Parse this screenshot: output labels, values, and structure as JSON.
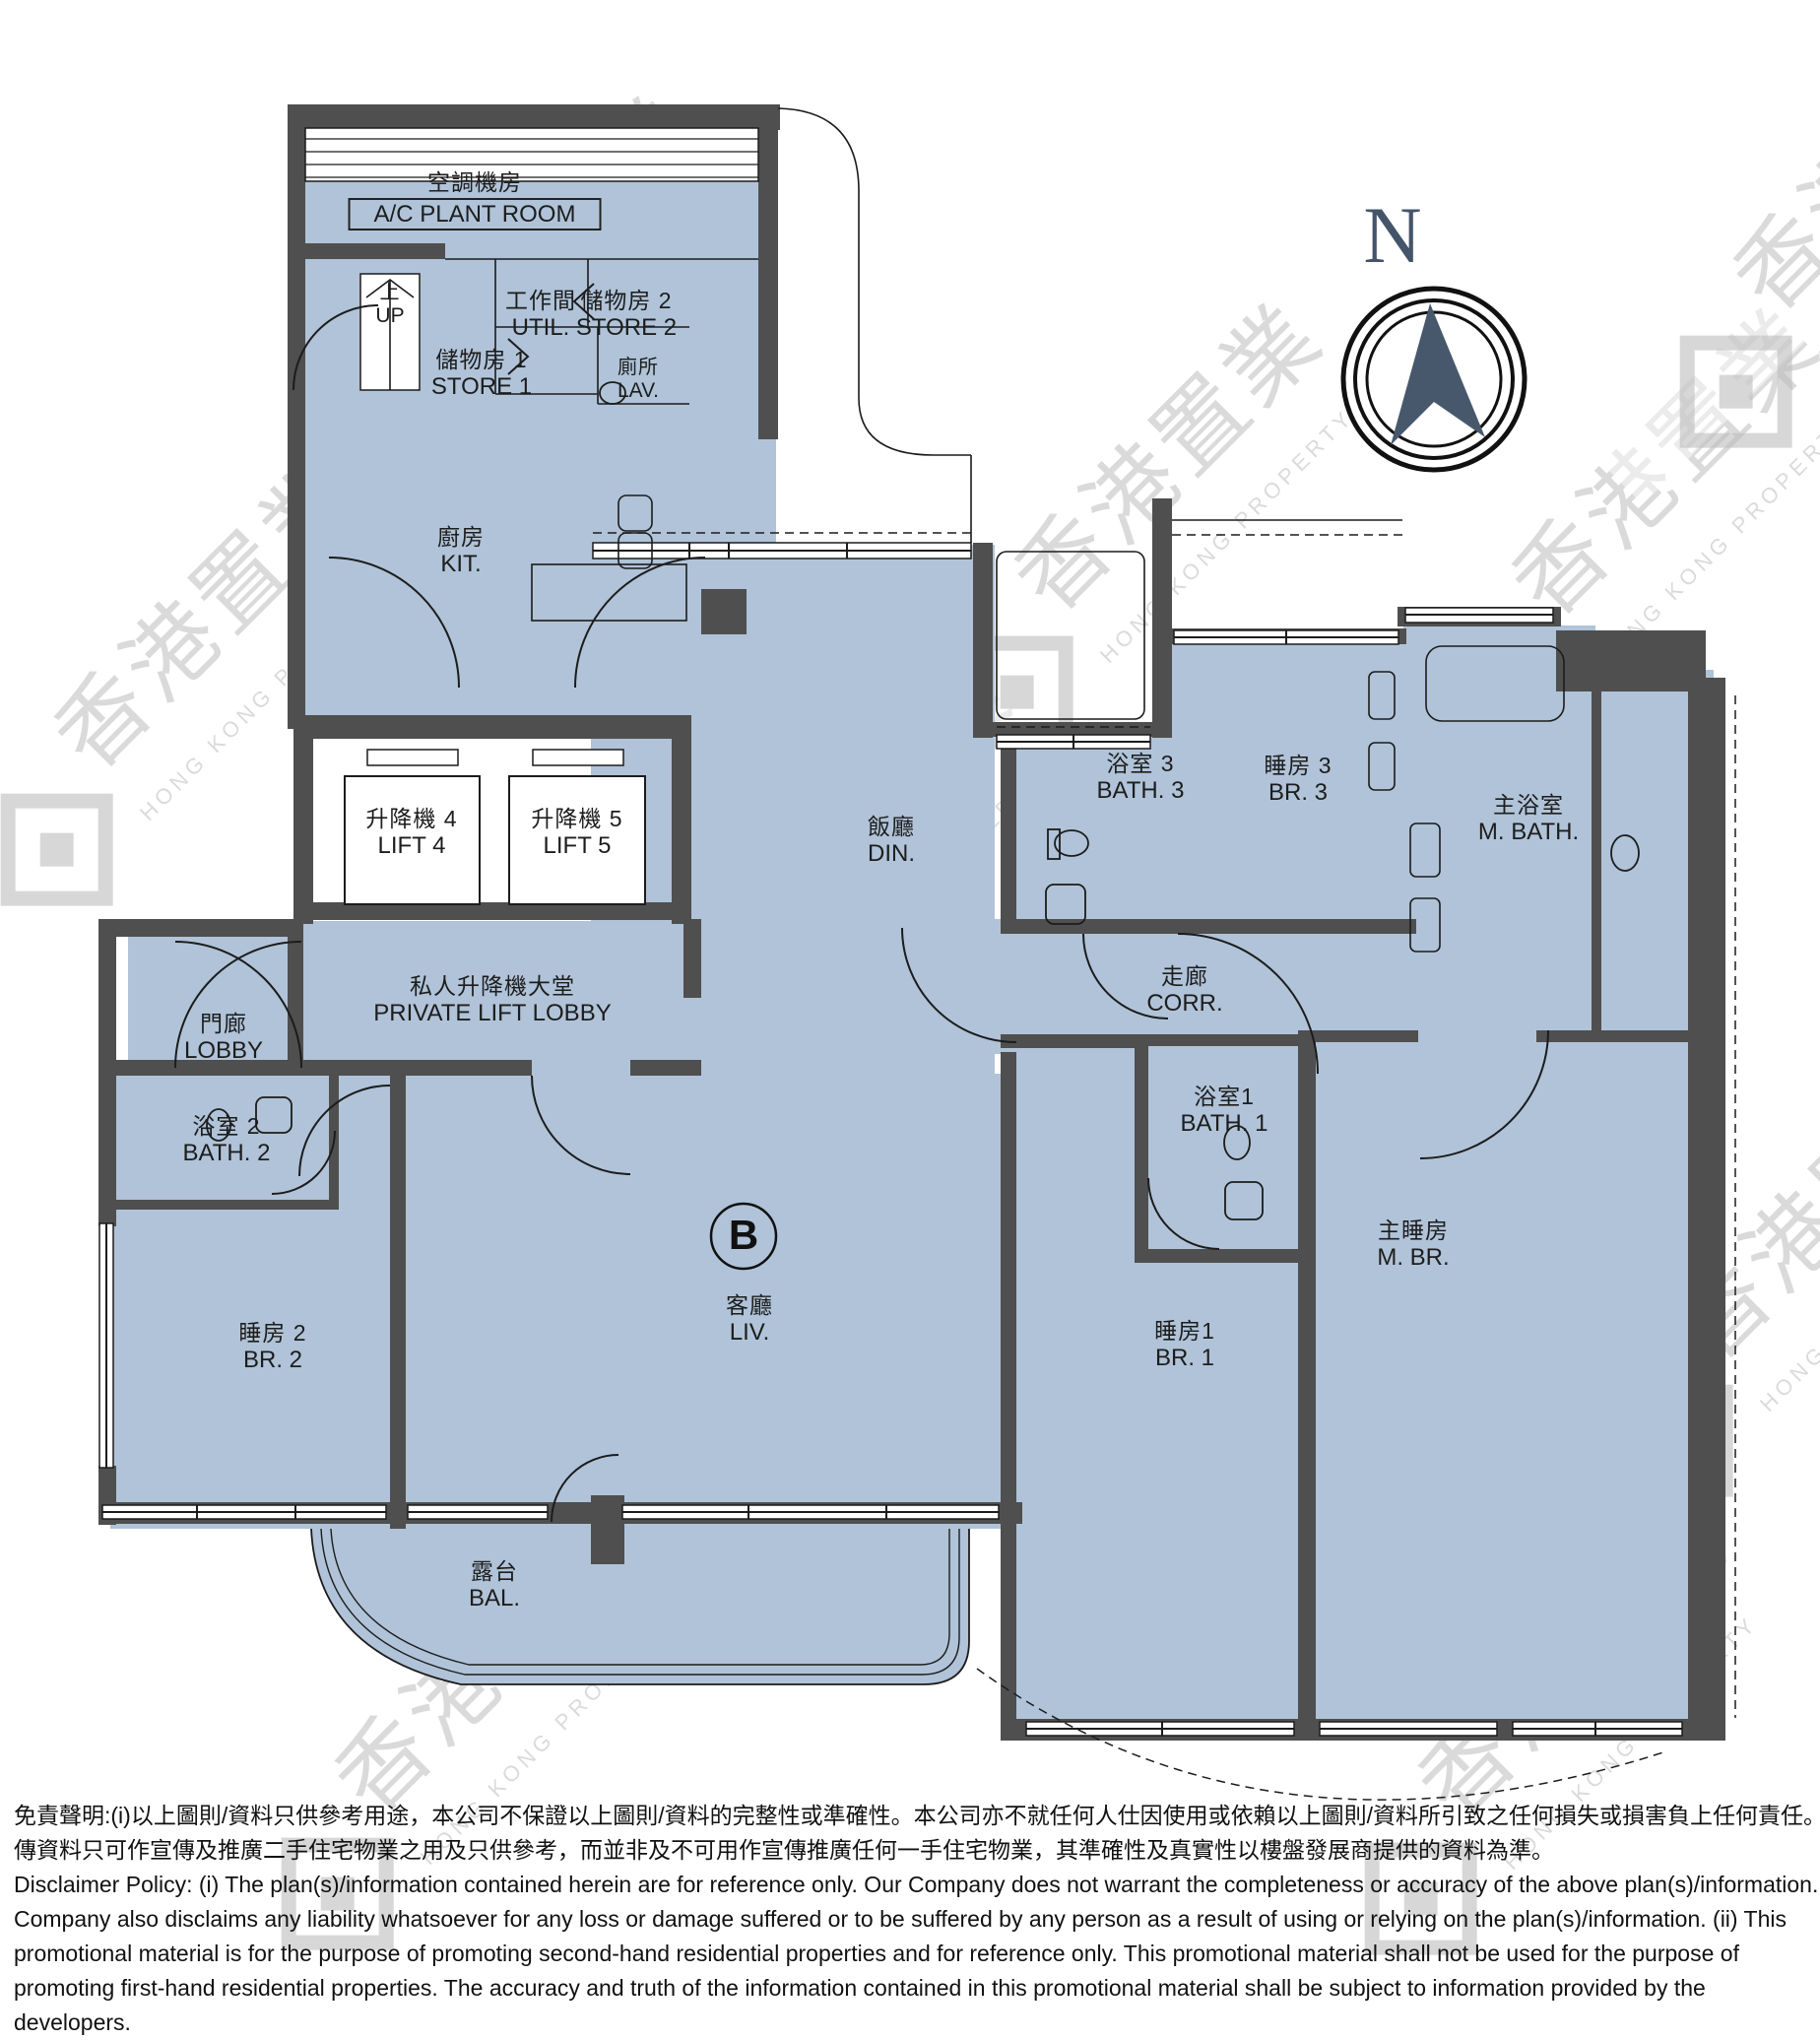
{
  "unit": "B",
  "compass_n": "N",
  "watermark": {
    "zh": "香港置業",
    "en": "HONG KONG PROPERTY"
  },
  "colors": {
    "floor": "#b0c3d8",
    "wall": "#4f4f4f",
    "compass": "#47586c",
    "line": "#1c1c1c"
  },
  "rooms": {
    "ac": {
      "zh": "空調機房",
      "en": "A/C PLANT ROOM"
    },
    "up": {
      "zh": "上",
      "en": "UP"
    },
    "util": {
      "zh": "工作間",
      "en": "UTIL."
    },
    "store2": {
      "zh": "儲物房 2",
      "en": "STORE 2"
    },
    "store1": {
      "zh": "儲物房 1",
      "en": "STORE 1"
    },
    "lav": {
      "zh": "廁所",
      "en": "LAV."
    },
    "kit": {
      "zh": "廚房",
      "en": "KIT."
    },
    "lift4": {
      "zh": "升降機 4",
      "en": "LIFT 4"
    },
    "lift5": {
      "zh": "升降機 5",
      "en": "LIFT 5"
    },
    "din": {
      "zh": "飯廳",
      "en": "DIN."
    },
    "bath3": {
      "zh": "浴室 3",
      "en": "BATH. 3"
    },
    "br3": {
      "zh": "睡房 3",
      "en": "BR. 3"
    },
    "mbath": {
      "zh": "主浴室",
      "en": "M. BATH."
    },
    "plobby": {
      "zh": "私人升降機大堂",
      "en": "PRIVATE LIFT LOBBY"
    },
    "lobby": {
      "zh": "門廊",
      "en": "LOBBY"
    },
    "corr": {
      "zh": "走廊",
      "en": "CORR."
    },
    "bath2": {
      "zh": "浴室 2",
      "en": "BATH. 2"
    },
    "bath1": {
      "zh": "浴室1",
      "en": "BATH. 1"
    },
    "br2": {
      "zh": "睡房 2",
      "en": "BR. 2"
    },
    "liv": {
      "zh": "客廳",
      "en": "LIV."
    },
    "br1": {
      "zh": "睡房1",
      "en": "BR. 1"
    },
    "mbr": {
      "zh": "主睡房",
      "en": "M. BR."
    },
    "bal": {
      "zh": "露台",
      "en": "BAL."
    }
  },
  "disclaimer": {
    "lines": [
      "免責聲明:(i)以上圖則/資料只供參考用途，本公司不保證以上圖則/資料的完整性或準確性。本公司亦不就任何人仕因使用或依賴以上圖則/資料所引致之任何損失或損害負上任何責任。(ii)本宣",
      "傳資料只可作宣傳及推廣二手住宅物業之用及只供參考，而並非及不可用作宣傳推廣任何一手住宅物業，其準確性及真實性以樓盤發展商提供的資料為準。",
      "Disclaimer Policy: (i) The plan(s)/information contained herein are for reference only. Our Company does not warrant the completeness or accuracy of the above plan(s)/information. Our",
      "Company also disclaims any liability whatsoever for any loss or damage suffered or to be suffered by any person as a result of using or relying on the plan(s)/information. (ii) This",
      "promotional material is for the purpose of promoting second-hand residential properties and for reference only. This promotional material shall not be used for the purpose of",
      "promoting first-hand residential properties. The accuracy and truth of the information contained in this promotional material shall be subject to information provided by the",
      "developers."
    ]
  }
}
